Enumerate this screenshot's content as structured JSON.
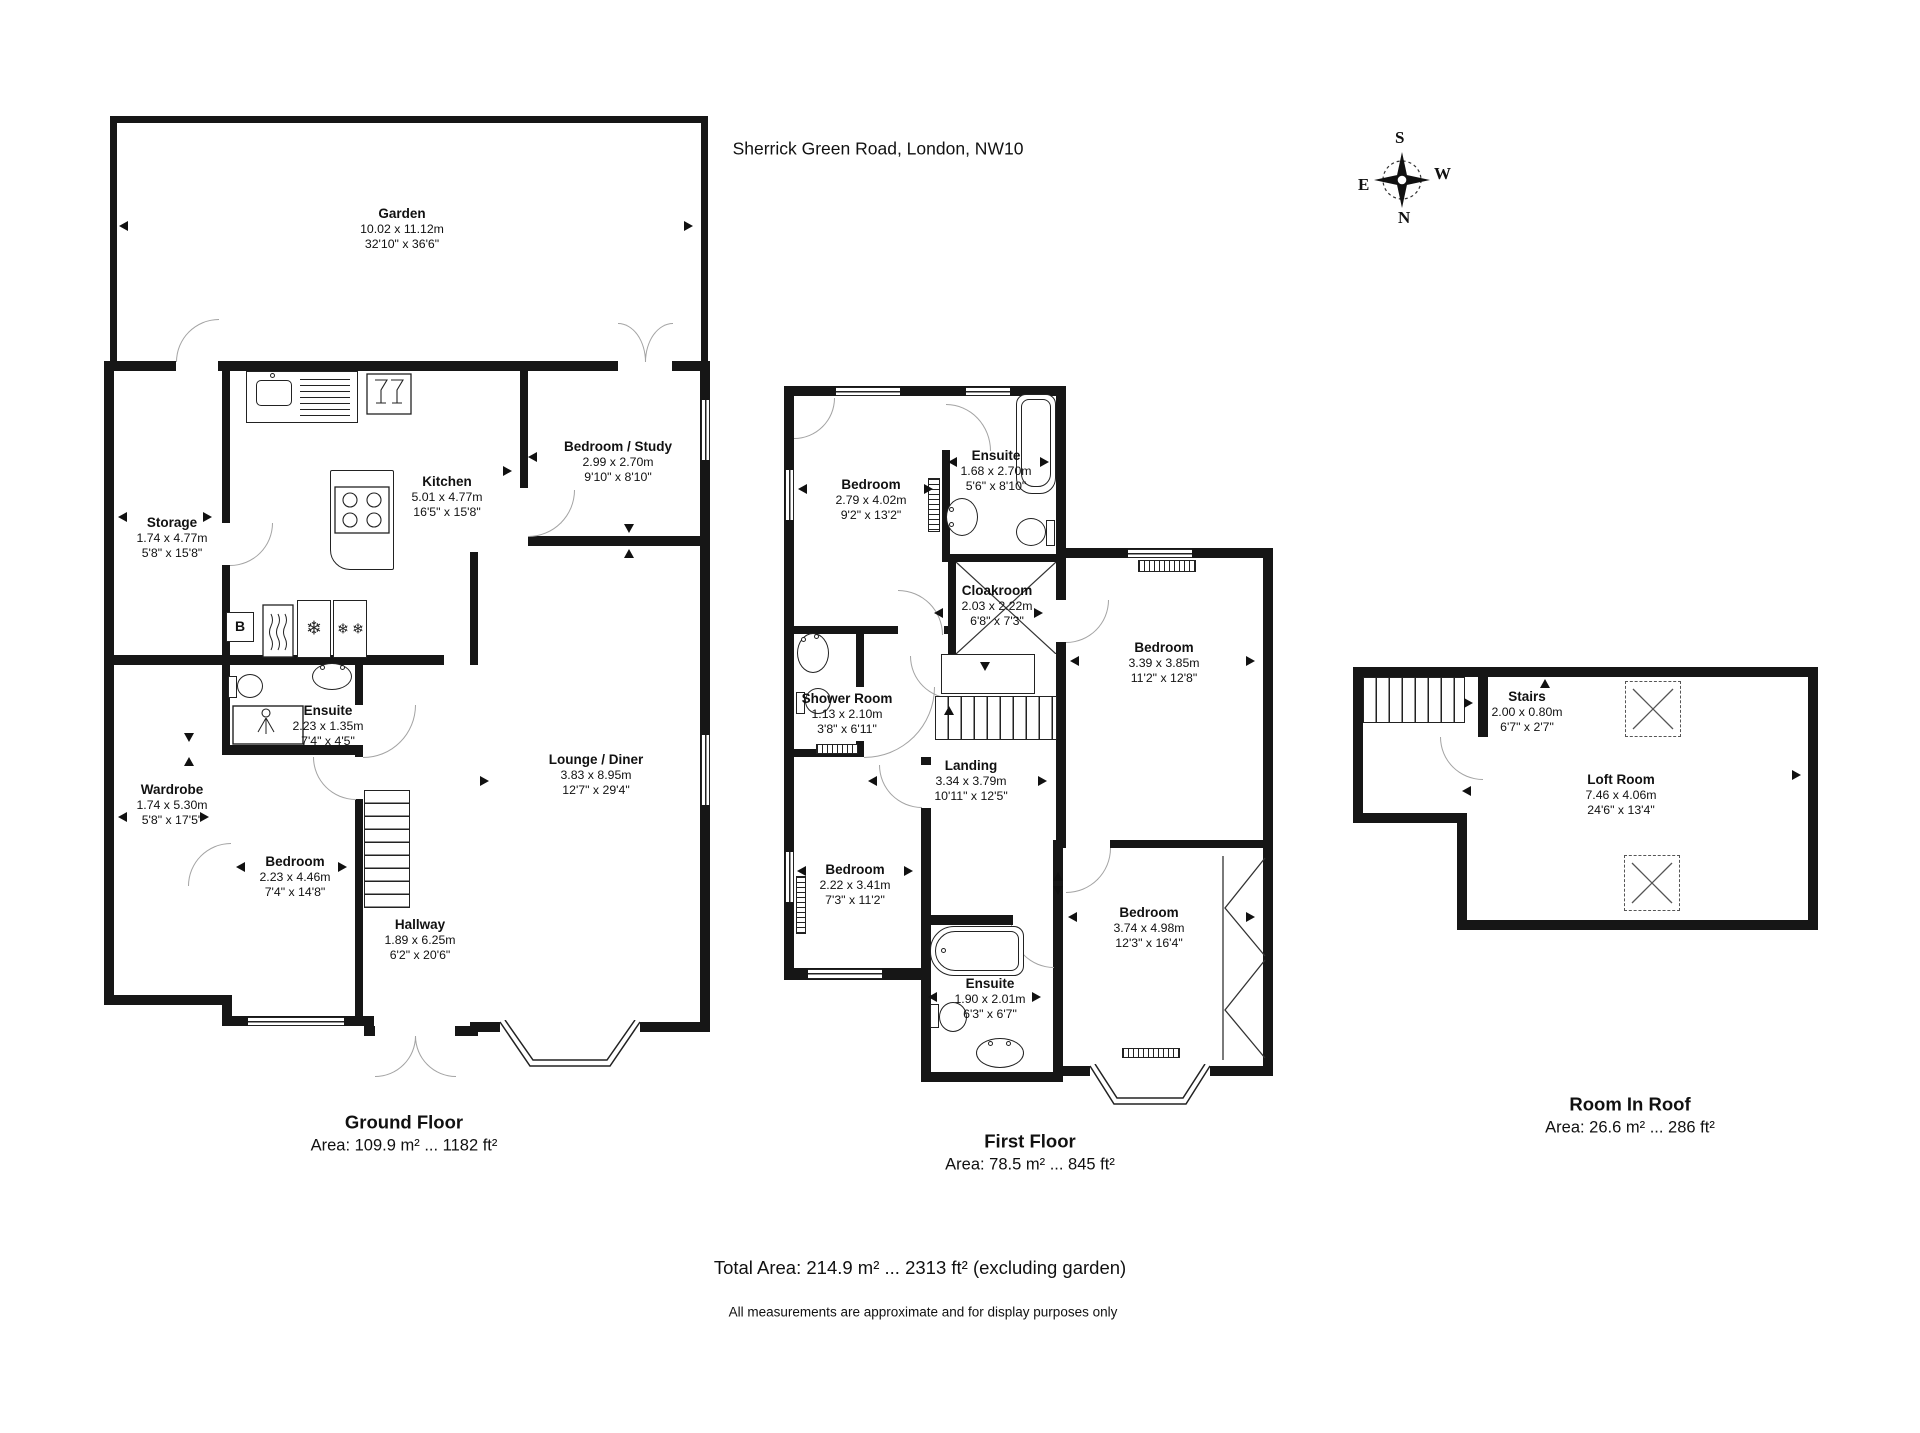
{
  "header": {
    "address": "Sherrick Green Road, London, NW10"
  },
  "compass": {
    "top": "S",
    "right": "W",
    "bottom": "N",
    "left": "E"
  },
  "labels": {
    "boiler": "B"
  },
  "icons": {
    "freezer_glyph": "❄"
  },
  "floors": {
    "ground": {
      "title": "Ground Floor",
      "area": "Area: 109.9 m² ... 1182 ft²",
      "rooms": {
        "garden": {
          "name": "Garden",
          "metric": "10.02 x 11.12m",
          "imperial": "32'10\" x 36'6\""
        },
        "storage": {
          "name": "Storage",
          "metric": "1.74 x 4.77m",
          "imperial": "5'8\" x 15'8\""
        },
        "kitchen": {
          "name": "Kitchen",
          "metric": "5.01 x 4.77m",
          "imperial": "16'5\" x 15'8\""
        },
        "bedroom_study": {
          "name": "Bedroom / Study",
          "metric": "2.99 x 2.70m",
          "imperial": "9'10\" x 8'10\""
        },
        "ensuite": {
          "name": "Ensuite",
          "metric": "2.23 x 1.35m",
          "imperial": "7'4\" x 4'5\""
        },
        "wardrobe": {
          "name": "Wardrobe",
          "metric": "1.74 x 5.30m",
          "imperial": "5'8\" x 17'5\""
        },
        "bedroom": {
          "name": "Bedroom",
          "metric": "2.23 x 4.46m",
          "imperial": "7'4\" x 14'8\""
        },
        "hallway": {
          "name": "Hallway",
          "metric": "1.89 x 6.25m",
          "imperial": "6'2\" x 20'6\""
        },
        "lounge_diner": {
          "name": "Lounge / Diner",
          "metric": "3.83 x 8.95m",
          "imperial": "12'7\" x 29'4\""
        }
      }
    },
    "first": {
      "title": "First Floor",
      "area": "Area: 78.5 m² ... 845 ft²",
      "rooms": {
        "bedroom_front": {
          "name": "Bedroom",
          "metric": "2.79 x 4.02m",
          "imperial": "9'2\" x 13'2\""
        },
        "ensuite_front": {
          "name": "Ensuite",
          "metric": "1.68 x 2.70m",
          "imperial": "5'6\" x 8'10\""
        },
        "cloakroom": {
          "name": "Cloakroom",
          "metric": "2.03 x 2.22m",
          "imperial": "6'8\" x 7'3\""
        },
        "bedroom_side": {
          "name": "Bedroom",
          "metric": "3.39 x 3.85m",
          "imperial": "11'2\" x 12'8\""
        },
        "shower_room": {
          "name": "Shower Room",
          "metric": "1.13 x 2.10m",
          "imperial": "3'8\" x 6'11\""
        },
        "landing": {
          "name": "Landing",
          "metric": "3.34 x 3.79m",
          "imperial": "10'11\" x 12'5\""
        },
        "bedroom_middle": {
          "name": "Bedroom",
          "metric": "2.22 x 3.41m",
          "imperial": "7'3\" x 11'2\""
        },
        "bedroom_rear": {
          "name": "Bedroom",
          "metric": "3.74 x 4.98m",
          "imperial": "12'3\" x 16'4\""
        },
        "ensuite_rear": {
          "name": "Ensuite",
          "metric": "1.90 x 2.01m",
          "imperial": "6'3\" x 6'7\""
        }
      }
    },
    "roof": {
      "title": "Room In Roof",
      "area": "Area: 26.6 m² ... 286 ft²",
      "rooms": {
        "stairs": {
          "name": "Stairs",
          "metric": "2.00 x 0.80m",
          "imperial": "6'7\" x 2'7\""
        },
        "loft_room": {
          "name": "Loft Room",
          "metric": "7.46 x 4.06m",
          "imperial": "24'6\" x 13'4\""
        }
      }
    }
  },
  "footer": {
    "total": "Total Area: 214.9 m² ... 2313 ft² (excluding garden)",
    "disclaimer": "All measurements are approximate and for display purposes only"
  }
}
